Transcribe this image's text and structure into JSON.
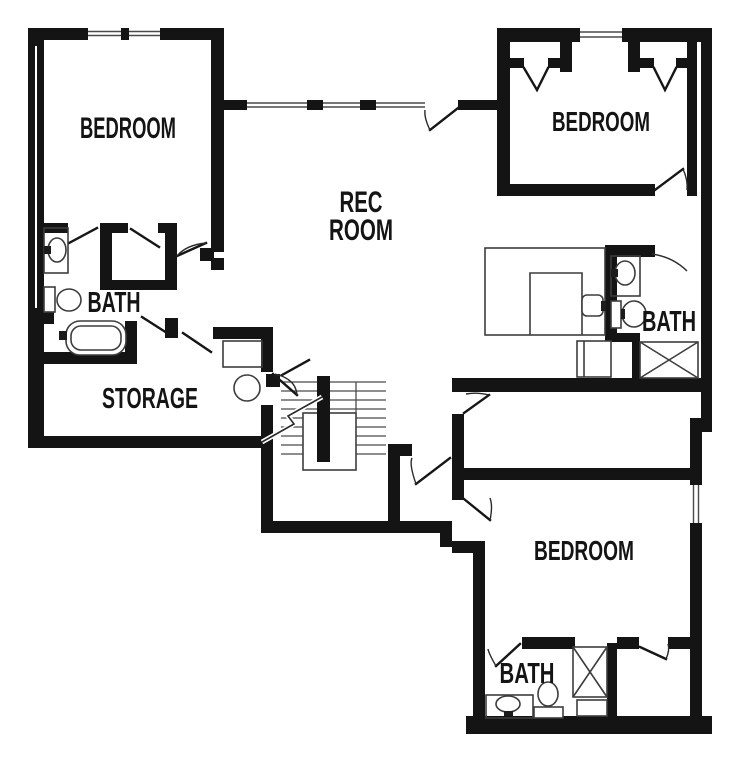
{
  "page": {
    "background": "#ffffff"
  },
  "floor_plan": {
    "type": "basement-floor-plan",
    "colors": {
      "wall": "#141414",
      "fixture_line": "#3d3d3d",
      "label": "#141414"
    },
    "labels": {
      "bedroom_top_left": "BEDROOM",
      "rec_room_line1": "REC",
      "rec_room_line2": "ROOM",
      "bedroom_top_right": "BEDROOM",
      "bath_left": "BATH",
      "storage": "STORAGE",
      "bath_right": "BATH",
      "bedroom_bottom": "BEDROOM",
      "bath_bottom": "BATH"
    },
    "fixtures": {
      "bath_left": [
        "sink",
        "toilet",
        "bathtub"
      ],
      "bath_right": [
        "sink",
        "toilet",
        "shower"
      ],
      "bath_bottom": [
        "sink",
        "toilet",
        "shower",
        "cabinet"
      ],
      "rec_room": [
        "wet-bar-counter",
        "bar-sink",
        "mini-fridge"
      ],
      "storage": [
        "utility-box",
        "water-heater"
      ],
      "circulation": [
        "staircase"
      ]
    }
  }
}
